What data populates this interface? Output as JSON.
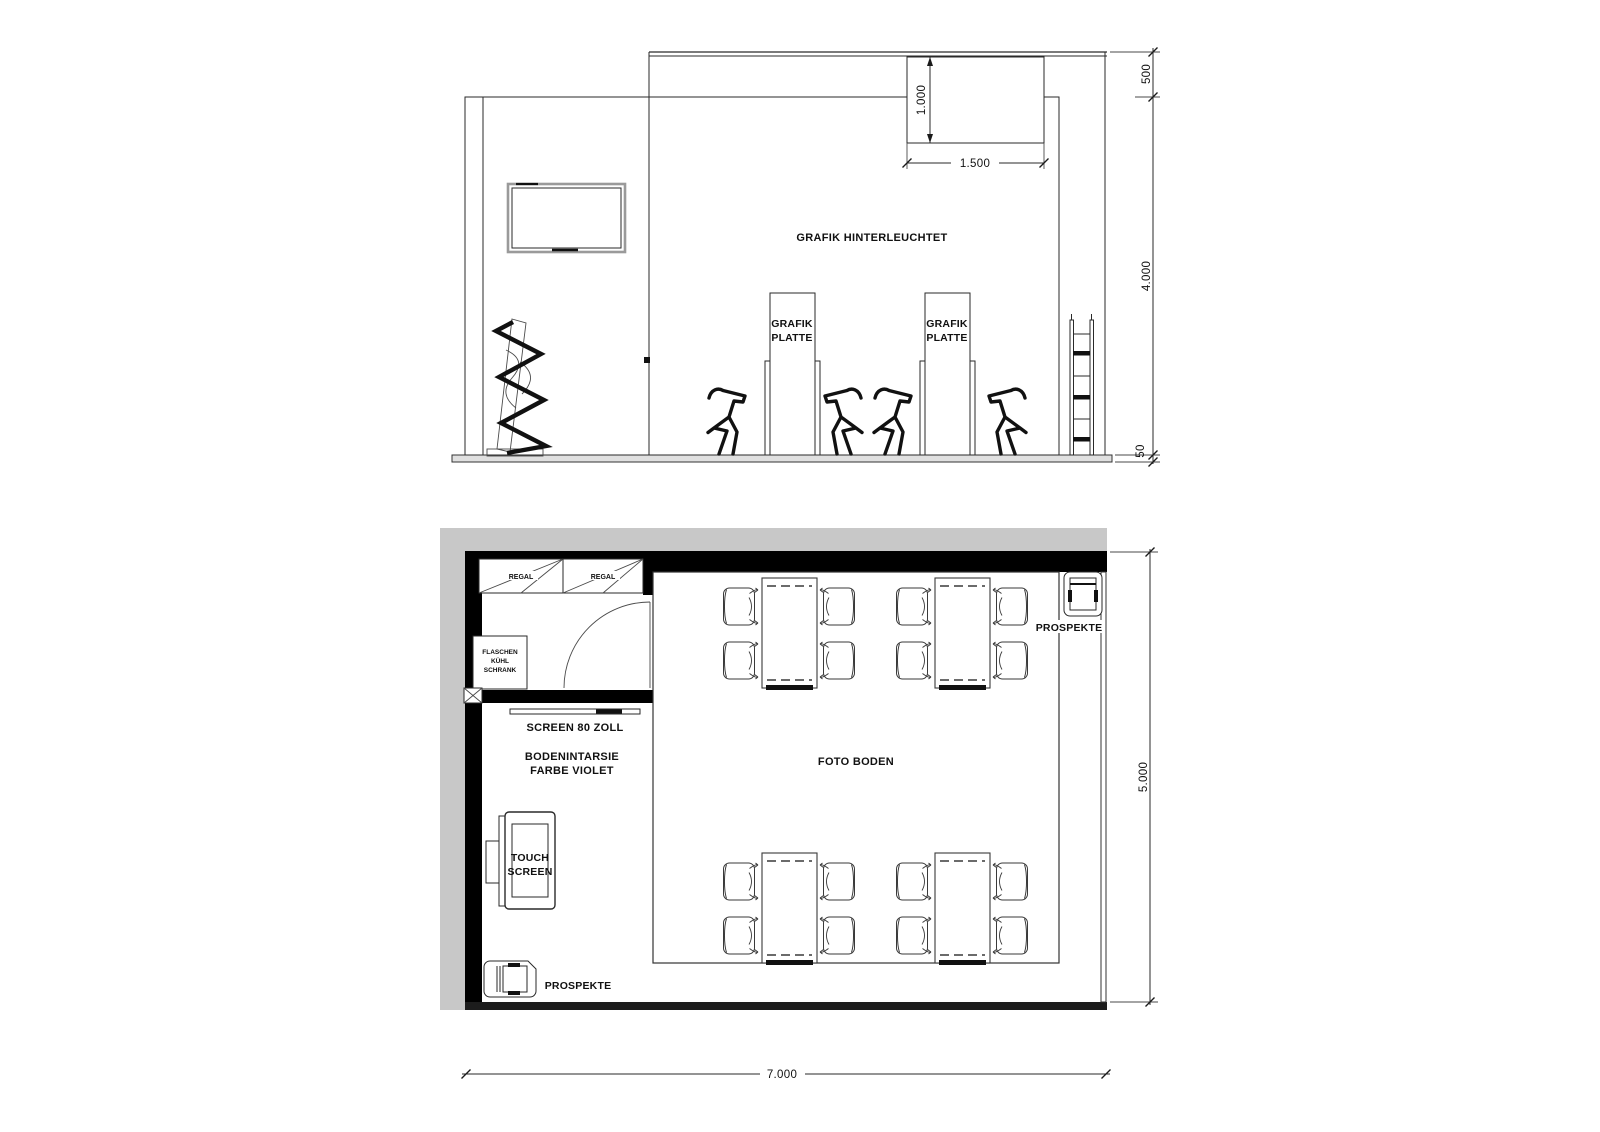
{
  "colors": {
    "ink": "#1a1a1a",
    "wall_black": "#000000",
    "gray_band": "#c8c8c8",
    "floor_fill": "#e0e0e0"
  },
  "elevation": {
    "labels": {
      "backlit_graphic": "GRAFIK HINTERLEUCHTET",
      "graphic_panel_left": [
        "GRAFIK",
        "PLATTE"
      ],
      "graphic_panel_right": [
        "GRAFIK",
        "PLATTE"
      ]
    },
    "dimensions": {
      "banner_drop": "1.000",
      "banner_width": "1.500",
      "header_height": "500",
      "wall_height": "4.000",
      "platform_height": "50"
    }
  },
  "plan": {
    "labels": {
      "shelf_left": "REGAL",
      "shelf_right": "REGAL",
      "bottle_fridge": [
        "FLASCHEN",
        "KÜHL",
        "SCHRANK"
      ],
      "screen": "SCREEN 80 ZOLL",
      "floor_inlay": [
        "BODENINTARSIE",
        "FARBE VIOLET"
      ],
      "touch_screen": [
        "TOUCH",
        "SCREEN"
      ],
      "brochures_bottom": "PROSPEKTE",
      "brochures_top": "PROSPEKTE",
      "photo_floor": "FOTO BODEN"
    },
    "dimensions": {
      "depth": "5.000",
      "width": "7.000"
    }
  }
}
